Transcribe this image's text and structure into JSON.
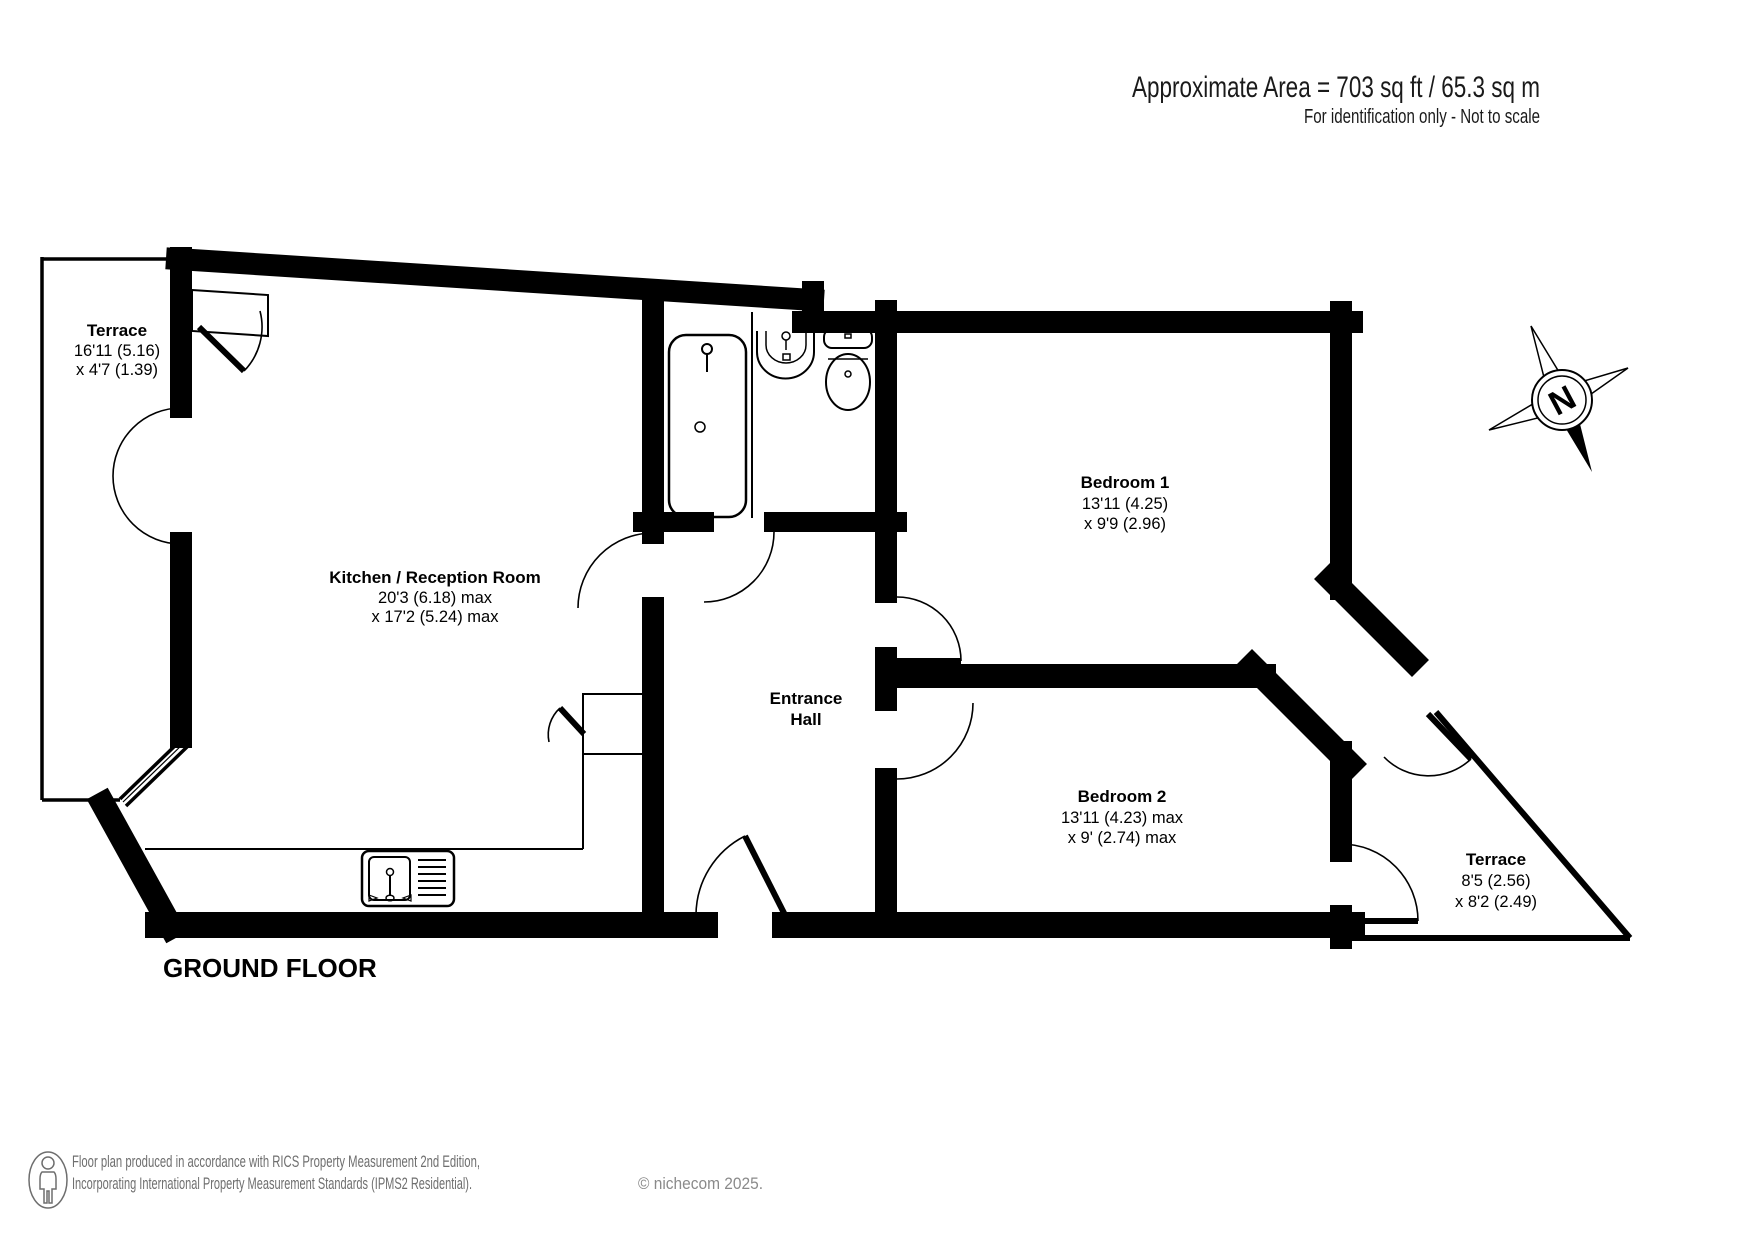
{
  "header": {
    "area_line": "Approximate Area = 703 sq ft / 65.3 sq m",
    "disclaimer": "For identification only - Not to scale"
  },
  "floor_label": "GROUND FLOOR",
  "compass": {
    "letter": "N"
  },
  "rooms": [
    {
      "id": "terrace-top",
      "name": "Terrace",
      "dim1": "16'11 (5.16)",
      "dim2": "x 4'7 (1.39)"
    },
    {
      "id": "kitchen",
      "name": "Kitchen / Reception Room",
      "dim1": "20'3 (6.18) max",
      "dim2": "x 17'2 (5.24) max"
    },
    {
      "id": "entrance-hall",
      "name": "Entrance",
      "name2": "Hall"
    },
    {
      "id": "bedroom-1",
      "name": "Bedroom 1",
      "dim1": "13'11 (4.25)",
      "dim2": "x 9'9 (2.96)"
    },
    {
      "id": "bedroom-2",
      "name": "Bedroom 2",
      "dim1": "13'11 (4.23) max",
      "dim2": "x 9' (2.74) max"
    },
    {
      "id": "terrace-right",
      "name": "Terrace",
      "dim1": "8'5 (2.56)",
      "dim2": "x 8'2 (2.49)"
    }
  ],
  "footer": {
    "line1": "Floor plan produced in accordance with RICS Property Measurement 2nd Edition,",
    "line2": "Incorporating International Property Measurement Standards (IPMS2 Residential).",
    "copyright": "© nichecom 2025."
  }
}
